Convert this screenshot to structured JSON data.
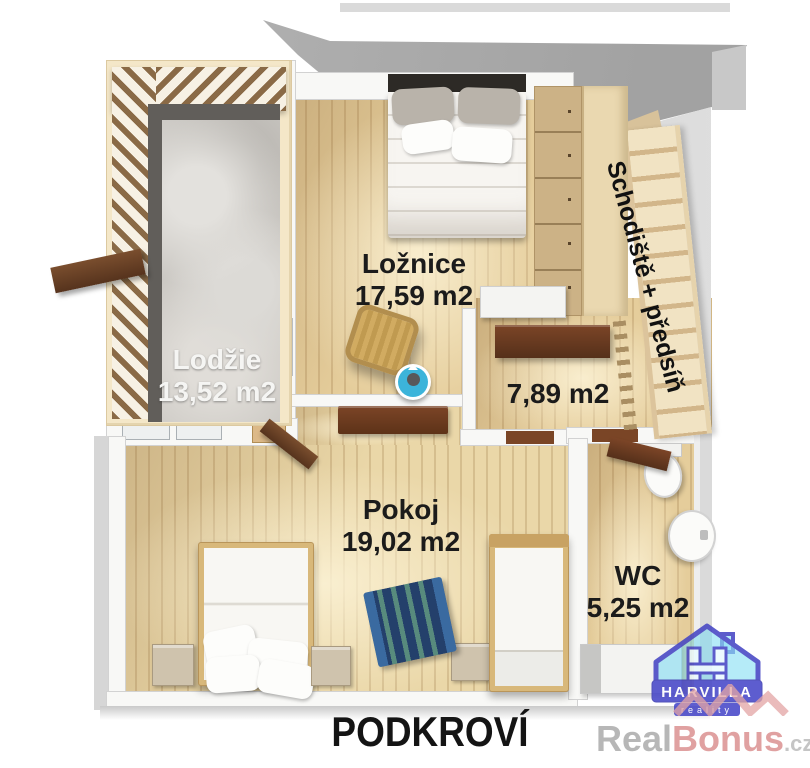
{
  "plan": {
    "title": "PODKROVÍ",
    "rooms": {
      "loznice": {
        "name": "Ložnice",
        "area": "17,59 m2"
      },
      "lodzie": {
        "name": "Lodžie",
        "area": "13,52 m2"
      },
      "mezipokoj": {
        "area": "7,89 m2"
      },
      "schodiste": {
        "name": "Schodiště + předsíň"
      },
      "pokoj": {
        "name": "Pokoj",
        "area": "19,02 m2"
      },
      "wc": {
        "name": "WC",
        "area": "5,25 m2"
      }
    }
  },
  "branding": {
    "agency": {
      "name": "HARVILLA",
      "tagline": "reality"
    },
    "portal": {
      "prefix": "Real",
      "suffix": "Bonus",
      "tld": ".cz"
    }
  },
  "colors": {
    "roof_gray": "#a8a8a8",
    "wood_floor": "#e5cd9b",
    "loggia_concrete": "#cac7c2",
    "furniture_brown": "#6e3b23",
    "logo_blue": "#4646c8",
    "logo_cyan": "#7fdcf0",
    "watermark_pink": "#df9c9c",
    "label_black": "#1b1b1b"
  }
}
